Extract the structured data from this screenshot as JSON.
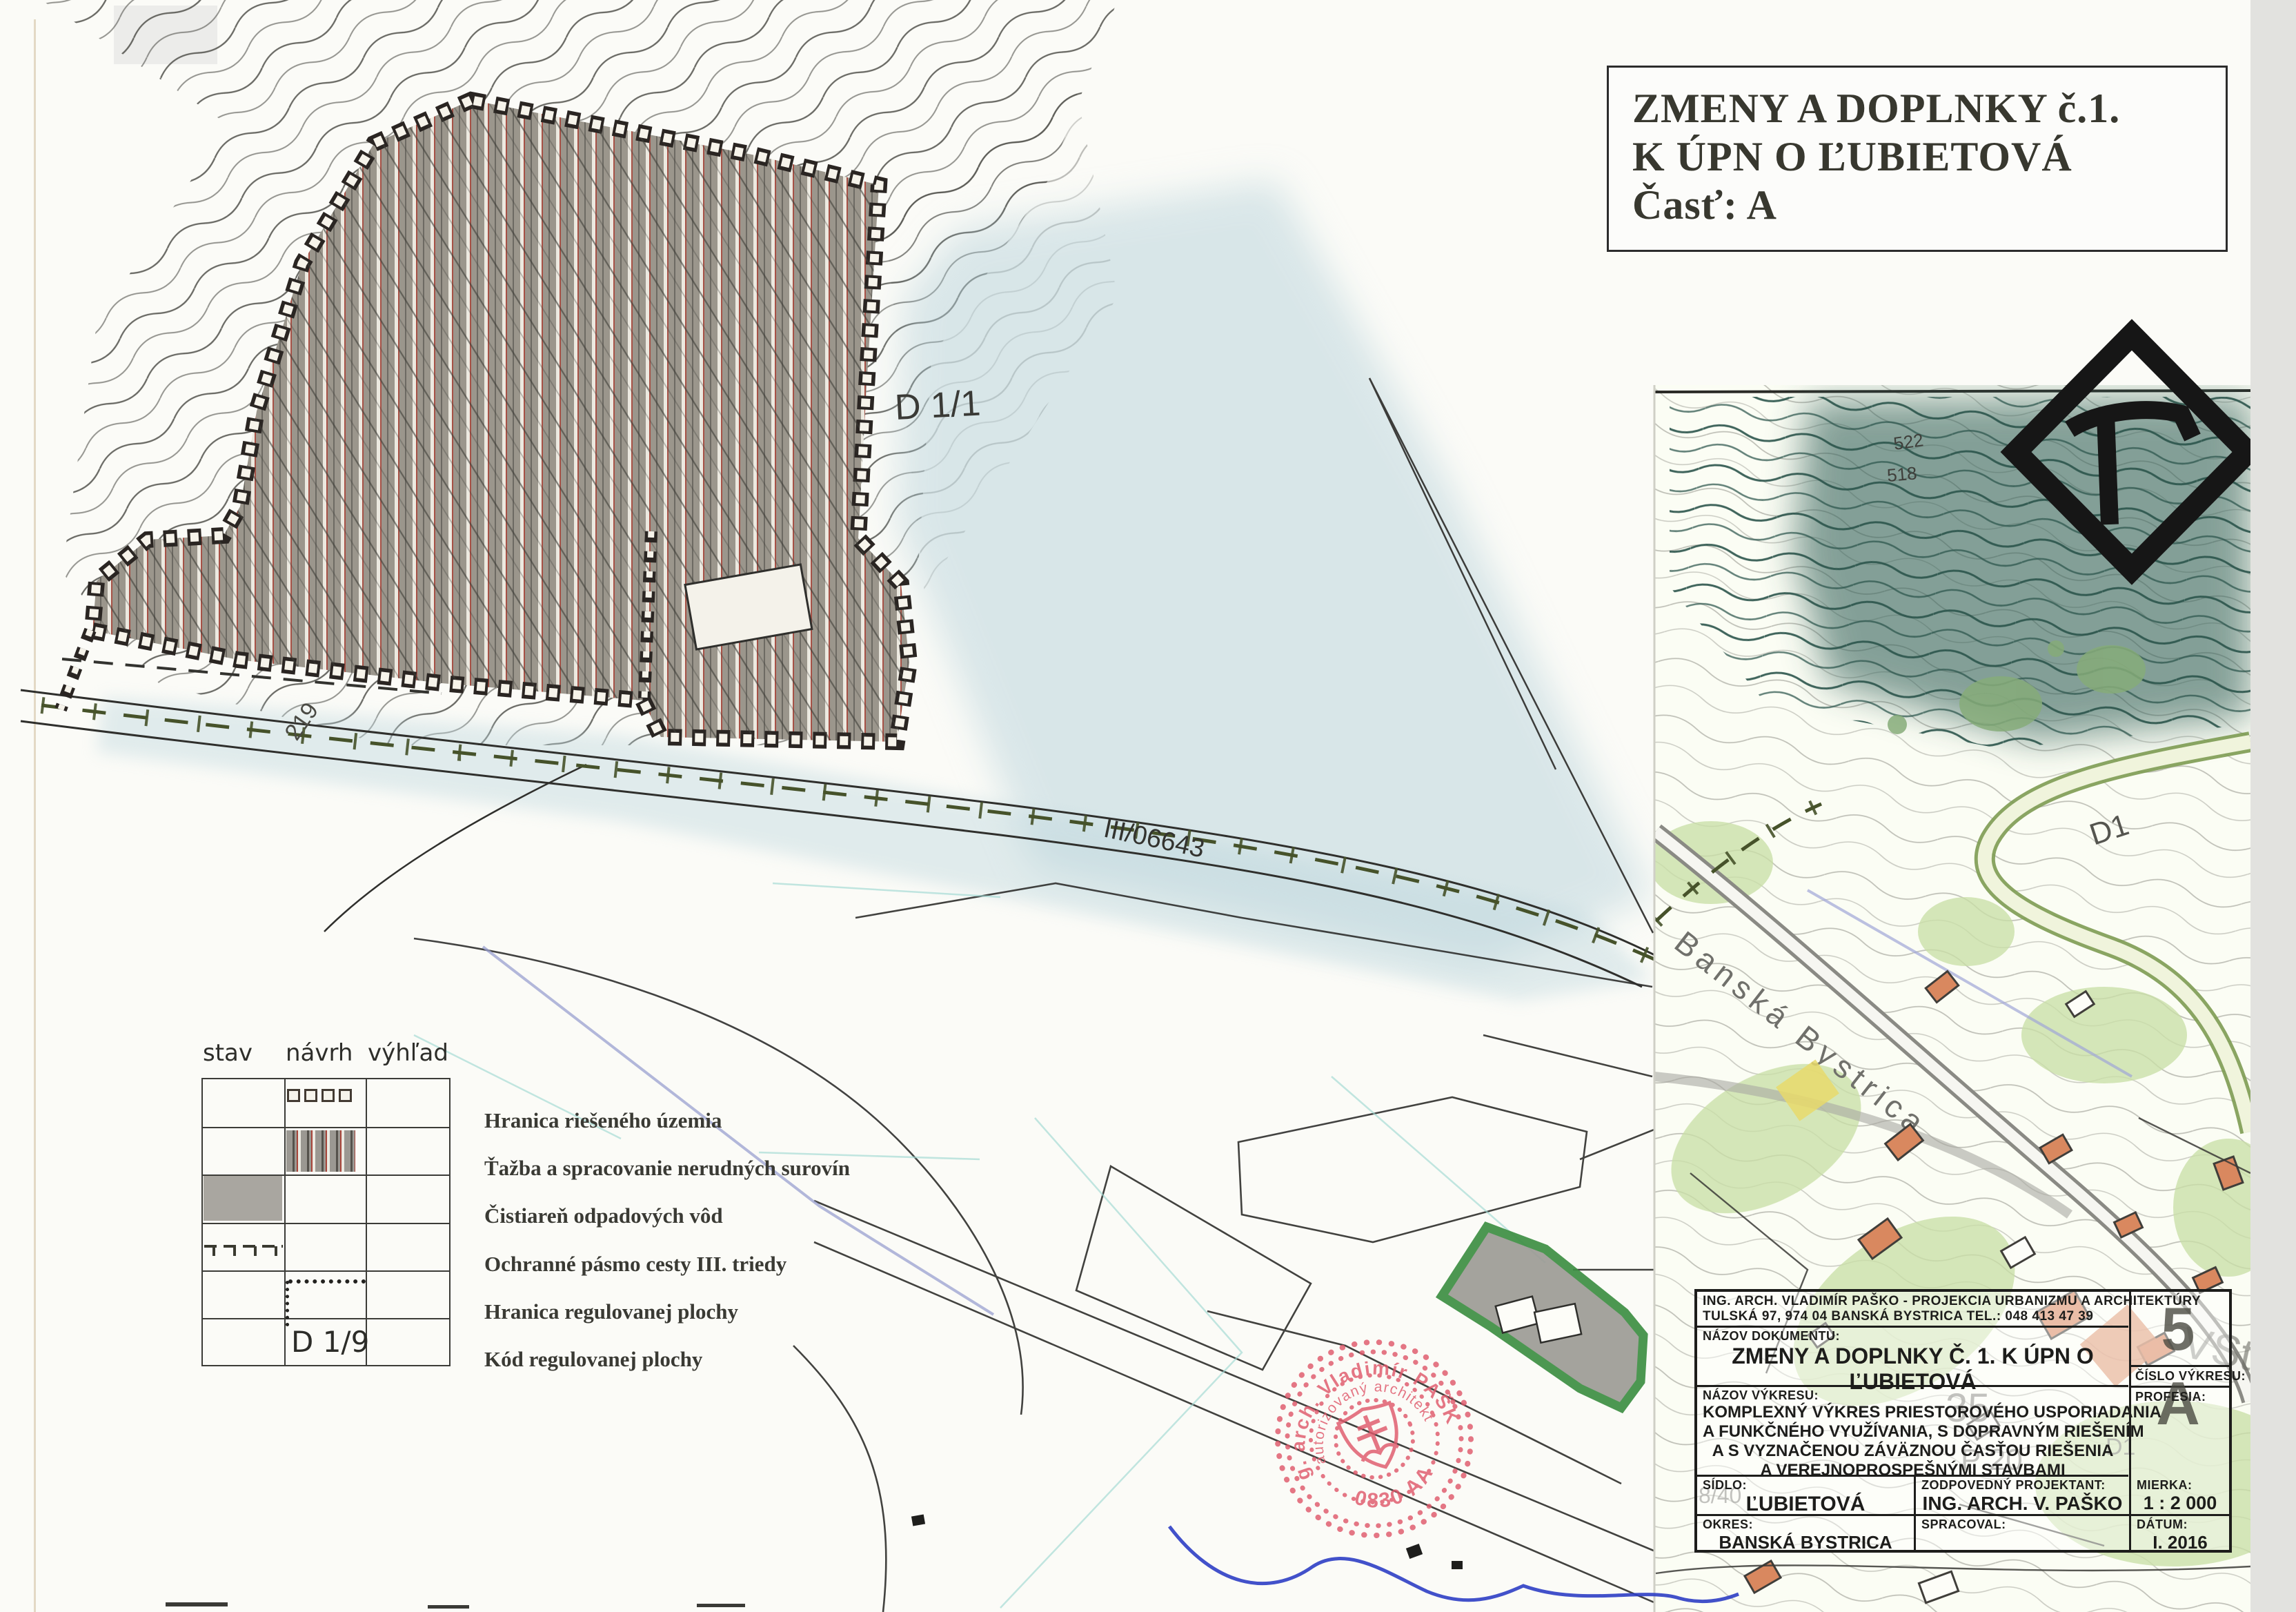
{
  "sheet": {
    "title_lines": [
      "ZMENY A DOPLNKY č.1.",
      "K ÚPN O ĽUBIETOVÁ",
      "Časť: A"
    ]
  },
  "legend": {
    "col_headers": [
      "stav",
      "návrh",
      "výhľad"
    ],
    "items": [
      "Hranica riešeného územia",
      "Ťažba a spracovanie nerudných surovín",
      "Čistiareň odpadových vôd",
      "Ochranné pásmo cesty III. triedy",
      "Hranica regulovanej plochy",
      "Kód regulovanej plochy"
    ],
    "code_sample": "D 1/9"
  },
  "map": {
    "area_code": "D 1/1",
    "road_number": "III/06643",
    "boundary_elevation": "219",
    "contour_elev_1": "522",
    "contour_elev_2": "518",
    "inset_road_code": "D1",
    "inset_street": "Banská Bystrica",
    "underlay": {
      "u1": "35",
      "u2": "P 20",
      "u3": "8/40",
      "u4": "D1",
      "u5": "VSt"
    }
  },
  "stamp": {
    "name_arc": "Ing. arch. Vladimír PAŠKO",
    "title_arc": "autorizovaný architekt",
    "number": "0830 AA"
  },
  "titleblock": {
    "firm_line1": "ING. ARCH. VLADIMÍR PAŠKO - PROJEKCIA URBANIZMU A ARCHITEKTÚRY",
    "firm_line2": "TULSKÁ 97, 974 04 BANSKÁ BYSTRICA TEL.: 048 413 47 39",
    "doc_label": "NÁZOV DOKUMENTU:",
    "doc_name_line1": "ZMENY A DOPLNKY Č. 1. K ÚPN O",
    "doc_name_line2": "ĽUBIETOVÁ",
    "drawing_label": "NÁZOV VÝKRESU:",
    "drawing_line1": "KOMPLEXNÝ VÝKRES PRIESTOROVÉHO USPORIADANIA",
    "drawing_line2": "A FUNKČNÉHO VYUŽÍVANIA, S DOPRAVNÝM RIEŠENÍM",
    "drawing_line3": "A S VYZNAČENOU ZÁVÄZNOU ČASŤOU RIEŠENIA",
    "drawing_line4": "A VEREJNOPROSPEŠNÝMI STAVBAMI",
    "sidlo_label": "SÍDLO:",
    "sidlo_value": "ĽUBIETOVÁ",
    "okres_label": "OKRES:",
    "okres_value": "BANSKÁ BYSTRICA",
    "projektant_label": "ZODPOVEDNÝ PROJEKTANT:",
    "projektant_value": "ING. ARCH. V. PAŠKO",
    "spracoval_label": "SPRACOVAL:",
    "spracoval_value": "",
    "mierka_label": "MIERKA:",
    "mierka_value": "1 : 2 000",
    "datum_label": "DÁTUM:",
    "datum_value": "I. 2016",
    "cislo_label": "ČÍSLO VÝKRESU:",
    "cislo_value": "5 A",
    "profesia_label": "PROFESIA:",
    "profesia_value": ""
  },
  "colors": {
    "stamp_red": "#e0596b",
    "signature_blue": "#2e3ec4",
    "wash_blue": "#b7d2da",
    "inset_teal": "#35625a",
    "vegetation_green": "#c9dfa6",
    "building_orange": "#d9885f",
    "cov_border_green": "#3e8f44",
    "mining_gray": "#9b968c",
    "protect_olive": "#46522a"
  }
}
